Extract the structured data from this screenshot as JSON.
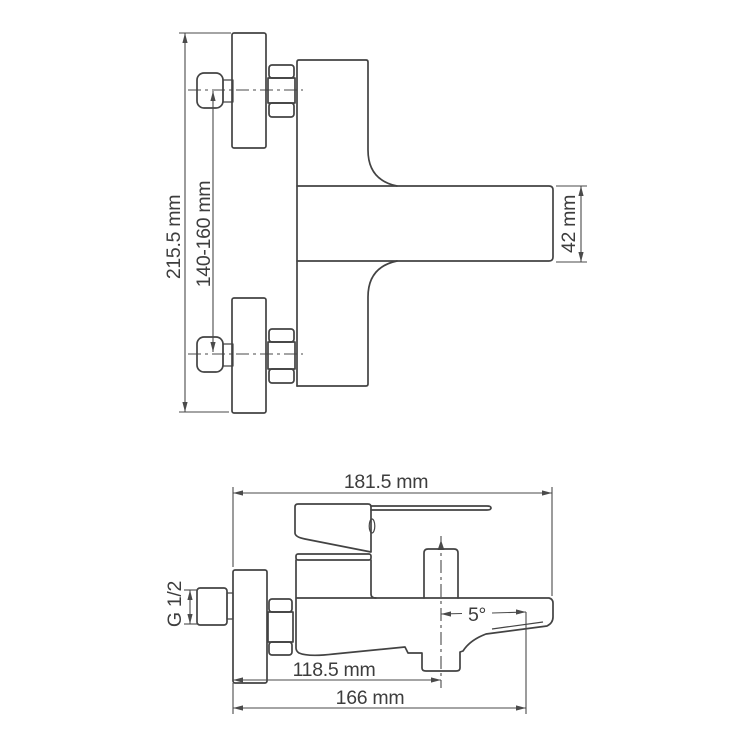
{
  "drawing": {
    "type": "technical-drawing-faucet",
    "background": "#ffffff",
    "line_color": "#434343",
    "front_view": {
      "dimensions": {
        "overall_height": "215.5 mm",
        "mounting_centers": "140-160 mm",
        "spout_height": "42 mm"
      }
    },
    "side_view": {
      "dimensions": {
        "overall_length": "181.5 mm",
        "thread": "G 1/2",
        "spout_angle": "5°",
        "outlet_offset": "118.5 mm",
        "spout_length": "166 mm"
      }
    }
  }
}
